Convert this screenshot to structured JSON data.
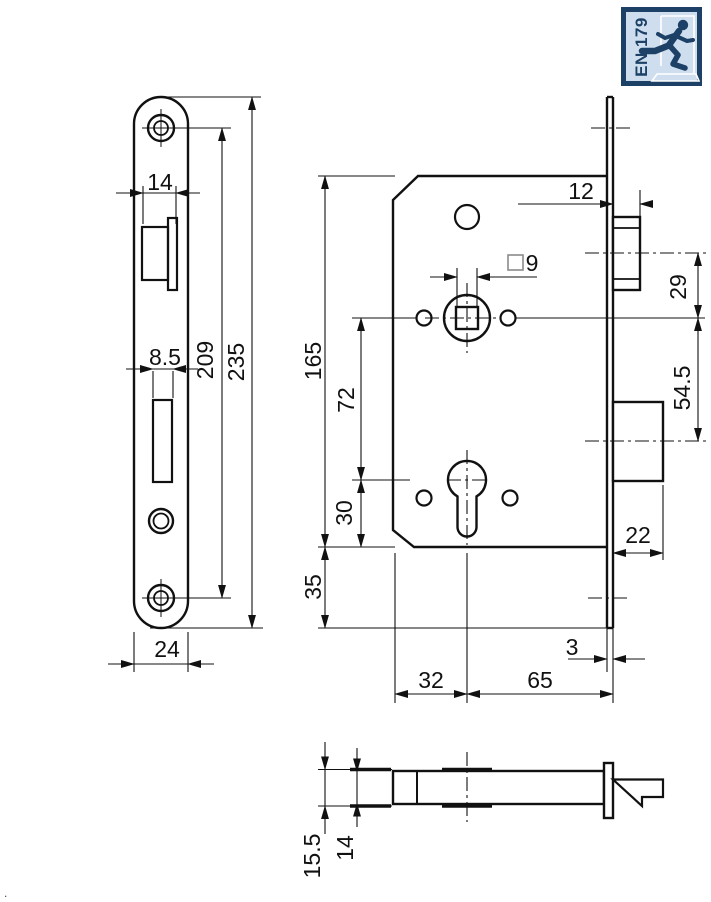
{
  "badge": {
    "label": "EN 179"
  },
  "page": {
    "corner_dot": "."
  },
  "dims": {
    "latch_width": "14",
    "slot_width": "8.5",
    "screw_centers": "209",
    "faceplate_height": "235",
    "faceplate_width": "24",
    "case_height": "165",
    "centre_distance": "72",
    "cyl_to_bottom": "30",
    "bottom_margin": "35",
    "latch_projection": "12",
    "spindle_square": "9",
    "latch_to_follower": "29",
    "follower_to_deadbolt": "54.5",
    "deadbolt_projection": "22",
    "faceplate_thickness": "3",
    "rear_backset": "32",
    "backset": "65",
    "case_thickness": "14",
    "overall_depth": "15.5"
  }
}
